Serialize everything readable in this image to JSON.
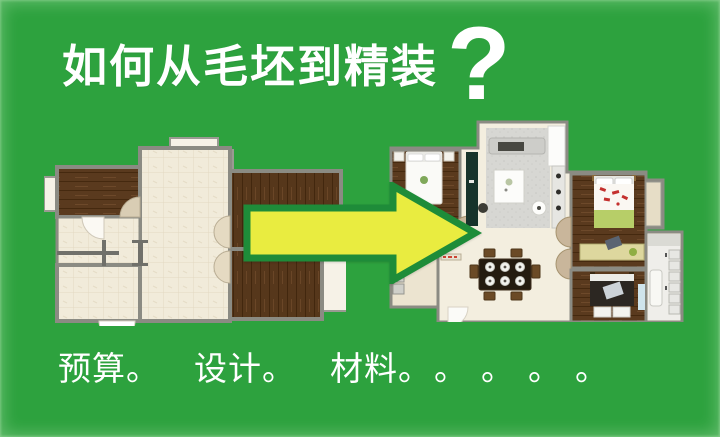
{
  "header": {
    "title": "如何从毛坯到精装",
    "question_mark": "?"
  },
  "footer": {
    "segments": [
      "预算。",
      "设计。",
      "材料。",
      "。",
      "。",
      "。",
      "。"
    ]
  },
  "colors": {
    "background": "#2da23e",
    "text": "#ffffff",
    "arrow_fill": "#e9ec40",
    "arrow_border": "#1e8c39",
    "wood_floor": "#5a3a1e",
    "tile_floor": "#f1ebda",
    "wall": "#8b8b83"
  }
}
